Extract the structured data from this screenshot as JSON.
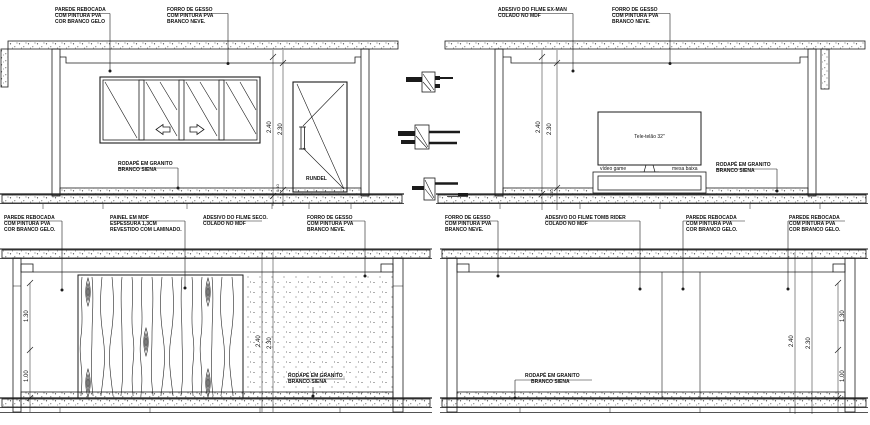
{
  "colors": {
    "line": "#1b1b1b",
    "background": "#ffffff",
    "text": "#111111"
  },
  "elev_a": {
    "parede": [
      "PAREDE REBOCADA",
      "COM PINTURA PVA",
      "COR BRANCO GELO"
    ],
    "forro": [
      "FORRO DE GESSO",
      "COM PINTURA PVA",
      "BRANCO NEVE."
    ],
    "rodape": [
      "RODAPÉ EM GRANITO",
      "BRANCO SIENA"
    ],
    "door": "RUNDEL",
    "dim_240": "2.40",
    "dim_230": "2.30",
    "dim_010": "0.10"
  },
  "elev_b": {
    "adesivo": [
      "ADESIVO DO FILME EX-MAN",
      "COLADO NO MDF"
    ],
    "forro": [
      "FORRO DE GESSO",
      "COM PINTURA PVA",
      "BRANCO NEVE."
    ],
    "tv": "Tele-telão 32\"",
    "video_game": "vídeo game",
    "mesa": "mesa baixa",
    "rodape": [
      "RODAPÉ EM GRANITO",
      "BRANCO SIENA"
    ],
    "dim_240": "2.40",
    "dim_230": "2.30",
    "dim_010": "0.10"
  },
  "elev_c": {
    "parede": [
      "PAREDE REBOCADA",
      "COM PINTURA PVA",
      "COR BRANCO GELO."
    ],
    "painel": [
      "PAINEL EM MDF",
      "ESPESSURA 1,3CM",
      "REVESTIDO COM LAMINADO."
    ],
    "adesivo": [
      "ADESIVO DO FILME SECO.",
      "COLADO NO MDF"
    ],
    "forro": [
      "FORRO DE GESSO",
      "COM PINTURA PVA",
      "BRANCO NEVE."
    ],
    "rodape": [
      "RODAPÉ EM GRANITO",
      "BRANCO SIENA"
    ],
    "dim_240": "2.40",
    "dim_230": "2.30",
    "dim_130": "1.30",
    "dim_100": "1.00"
  },
  "elev_d": {
    "forro": [
      "FORRO DE GESSO",
      "COM PINTURA PVA",
      "BRANCO NEVE."
    ],
    "adesivo": [
      "ADESIVO DO FILME TOMB RIDER",
      "COLADO NO MDF"
    ],
    "parede1": [
      "PAREDE REBOCADA",
      "COM PINTURA PVA",
      "COR BRANCO GELO."
    ],
    "parede2": [
      "PAREDE REBOCADA",
      "COM PINTURA PVA",
      "COR BRANCO GELO."
    ],
    "rodape": [
      "RODAPÉ EM GRANITO",
      "BRANCO SIENA"
    ],
    "dim_240": "2.40",
    "dim_230": "2.30",
    "dim_130": "1.30",
    "dim_100": "1.00"
  }
}
